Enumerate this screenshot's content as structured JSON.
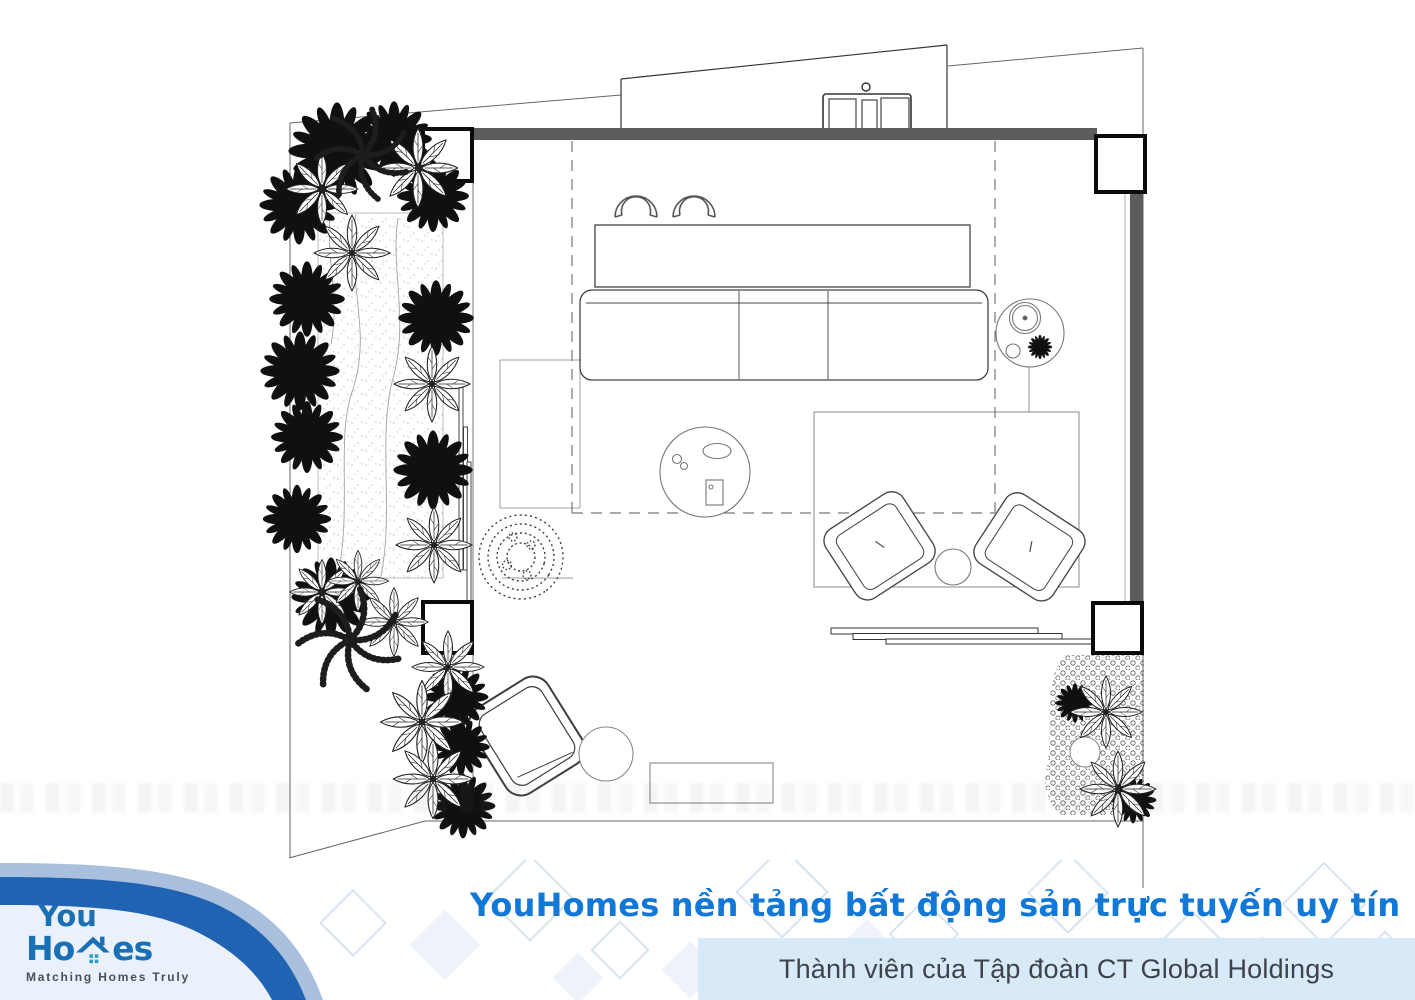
{
  "footer": {
    "brand_line": "YouHomes nền tảng bất động sản trực tuyến uy tín",
    "membership_line": "Thành viên của Tập đoàn CT Global Holdings",
    "logo": {
      "line1": "You",
      "line2_left": "Ho",
      "line2_right": "es",
      "tagline": "Matching Homes Truly"
    },
    "colors": {
      "brand_text_blue": "#1278d8",
      "logo_blue": "#1b6fb5",
      "ribbon_dark_blue": "#1f63b2",
      "ribbon_light_blue": "#a8bfdd",
      "footer_pale_blue": "#eaf1fa",
      "strip_background": "#d7e8f7",
      "strip_text": "#3e434b"
    }
  },
  "plan": {
    "type": "apartment-floor-plan-top-view",
    "icons": [
      "palm-tree-icon",
      "palmate-plant-icon",
      "fern-icon",
      "shrub-icon",
      "groundcover-icon",
      "bar-counter",
      "bar-stool",
      "sofa",
      "coffee-table",
      "side-table-lamp",
      "area-rug",
      "armchair",
      "round-side-table",
      "lounge-chair",
      "pouf",
      "bench",
      "sliding-glass-door",
      "structural-column",
      "wall",
      "sand-path",
      "window-sill-unit",
      "ceiling-zone-dashed"
    ],
    "plants": {
      "dark": [
        [
          337,
          151,
          1.35
        ],
        [
          394,
          139,
          1.05
        ],
        [
          433,
          196,
          1.0
        ],
        [
          299,
          205,
          1.1
        ],
        [
          307,
          299,
          1.05
        ],
        [
          300,
          371,
          1.1
        ],
        [
          307,
          437,
          1.0
        ],
        [
          297,
          519,
          0.95
        ],
        [
          331,
          597,
          1.1
        ],
        [
          436,
          318,
          1.05
        ],
        [
          433,
          470,
          1.1
        ],
        [
          456,
          697,
          0.9
        ],
        [
          461,
          747,
          0.8
        ],
        [
          463,
          806,
          0.9
        ],
        [
          1075,
          703,
          0.55
        ],
        [
          1133,
          800,
          0.65
        ]
      ],
      "hatched": [
        [
          418,
          168,
          1.1
        ],
        [
          322,
          189,
          1.0
        ],
        [
          352,
          253,
          1.05
        ],
        [
          432,
          384,
          1.05
        ],
        [
          434,
          545,
          1.05
        ],
        [
          322,
          592,
          0.9
        ],
        [
          358,
          581,
          0.85
        ],
        [
          394,
          622,
          0.95
        ],
        [
          448,
          667,
          1.0
        ],
        [
          422,
          722,
          1.15
        ],
        [
          433,
          779,
          1.1
        ],
        [
          1106,
          712,
          1.0
        ],
        [
          1118,
          789,
          1.05
        ]
      ],
      "fern": [
        [
          363,
          155,
          1.3
        ],
        [
          350,
          640,
          1.45
        ]
      ],
      "shrub": [
        [
          521,
          557,
          1.0
        ]
      ]
    }
  }
}
